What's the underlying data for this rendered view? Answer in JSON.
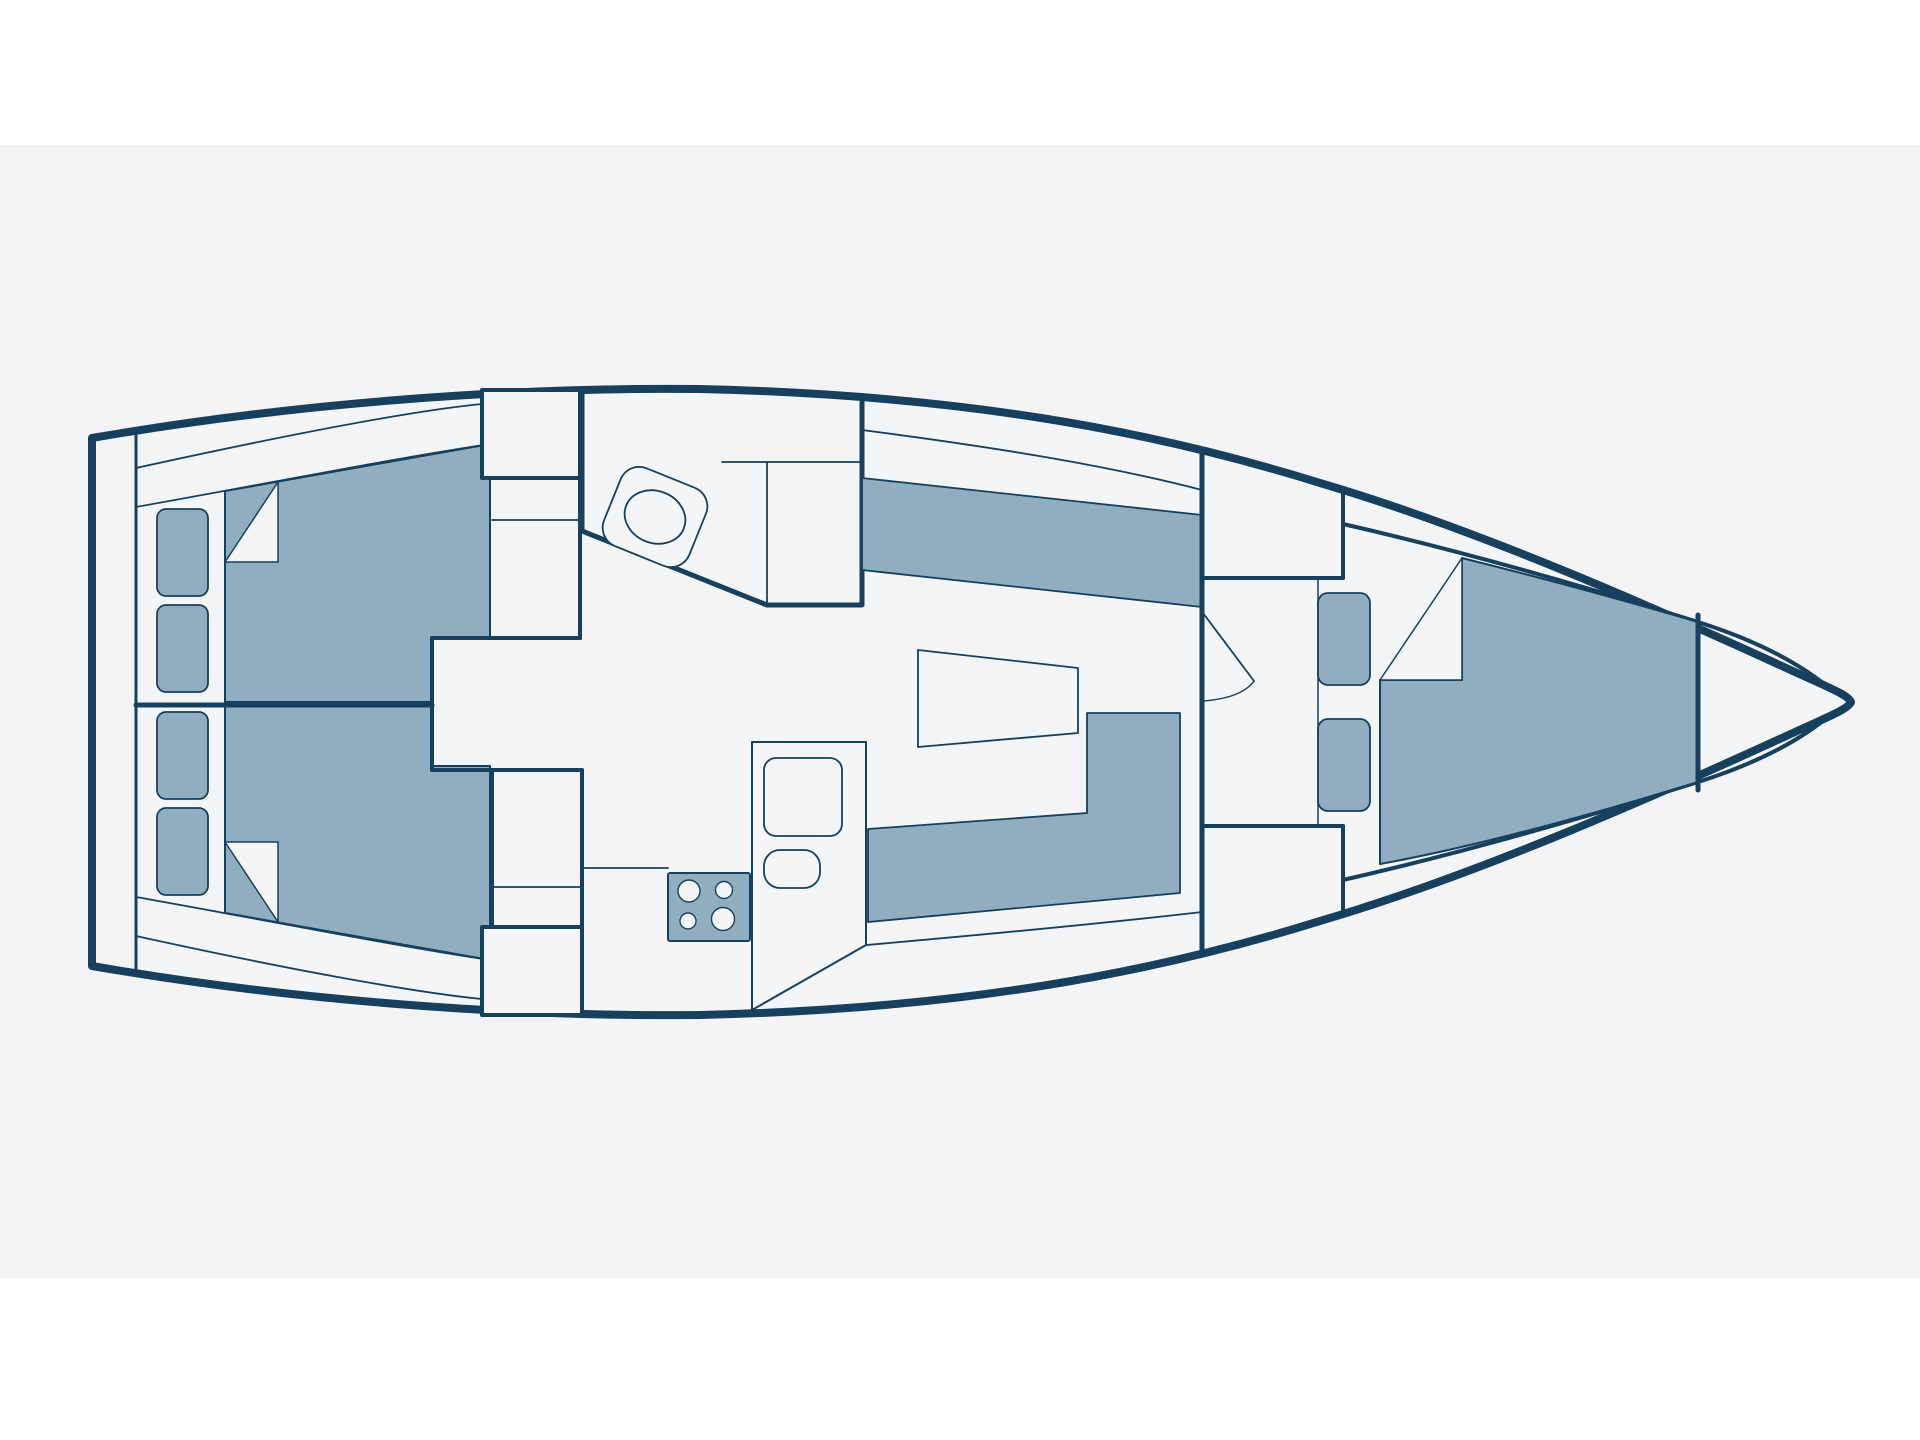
{
  "page": {
    "background": "#ffffff",
    "canvas_color": "#f4f4f6",
    "width": 1920,
    "height": 1440,
    "description": "Sailboat interior floor plan, top-down view, bow pointing right, no text labels"
  },
  "diagram": {
    "type": "boat-floor-plan",
    "colors": {
      "outline": "#16405e",
      "upholstery": "#91aec1",
      "surface": "#f4f4f6",
      "paper": "#f4f5f7"
    },
    "rooms": [
      {
        "name": "transom-lazarette"
      },
      {
        "name": "aft-cabin-port"
      },
      {
        "name": "aft-cabin-starboard"
      },
      {
        "name": "companionway-steps"
      },
      {
        "name": "head-toilet-room"
      },
      {
        "name": "galley"
      },
      {
        "name": "salon"
      },
      {
        "name": "forward-cabin"
      },
      {
        "name": "bow-anchor-locker"
      }
    ],
    "shapes": [
      {
        "name": "hull-outline",
        "kind": "path",
        "d": "M 92,438 C 300,402 520,387 700,389 C 960,395 1150,430 1320,483 C 1480,530 1660,610 1795,672 C 1830,688 1848,695 1851,702 C 1848,709 1830,716 1795,732 C 1660,794 1480,874 1320,921 C 1150,974 960,1009 700,1015 C 520,1017 300,1002 92,966 Z",
        "fill": "paper",
        "sw": 8
      },
      {
        "name": "transom-inner-wall",
        "kind": "path",
        "d": "M 136,431 L 136,973",
        "fill": "none",
        "sw": 3
      },
      {
        "name": "deck-line-top-outer",
        "kind": "path",
        "d": "M 136,468 C 300,432 420,410 482,404",
        "fill": "none",
        "sw": 1.8
      },
      {
        "name": "deck-line-top-inner",
        "kind": "path",
        "d": "M 136,507 C 260,485 390,459 490,444",
        "fill": "none",
        "sw": 1.8
      },
      {
        "name": "deck-line-top-salon",
        "kind": "path",
        "d": "M 862,430 C 1000,448 1110,466 1202,490",
        "fill": "none",
        "sw": 1.8
      },
      {
        "name": "deck-line-bottom-outer",
        "kind": "path",
        "d": "M 136,936 C 300,972 420,993 482,999",
        "fill": "none",
        "sw": 1.8
      },
      {
        "name": "deck-line-bottom-inner",
        "kind": "path",
        "d": "M 136,897 C 260,919 390,945 490,960",
        "fill": "none",
        "sw": 1.8
      },
      {
        "name": "deck-line-bottom-salon",
        "kind": "path",
        "d": "M 775,953 C 950,938 1090,925 1202,912",
        "fill": "none",
        "sw": 1.8
      },
      {
        "name": "fwd-trunk-line-top",
        "kind": "path",
        "d": "M 1343,524 C 1470,553 1590,588 1698,622 C 1755,640 1802,664 1834,692",
        "fill": "none",
        "sw": 4
      },
      {
        "name": "fwd-trunk-line-bottom",
        "kind": "path",
        "d": "M 1343,880 C 1470,851 1590,816 1698,782 C 1755,764 1802,740 1834,712",
        "fill": "none",
        "sw": 4
      },
      {
        "name": "aft-berth-port",
        "kind": "path",
        "d": "M 225,491 L 490,444 L 490,638 L 432,638 L 432,702 L 225,702 Z",
        "fill": "blue",
        "sw": 2
      },
      {
        "name": "aft-berth-starboard",
        "kind": "path",
        "d": "M 225,913 L 490,960 L 490,766 L 432,766 L 432,702 L 225,702 Z",
        "fill": "blue",
        "sw": 2
      },
      {
        "name": "pillow-port",
        "kind": "path",
        "d": "M 225,562 L 278,482 L 278,562 Z",
        "fill": "paper",
        "sw": 1.5
      },
      {
        "name": "pillow-starboard",
        "kind": "path",
        "d": "M 225,842 L 278,922 L 278,842 Z",
        "fill": "paper",
        "sw": 1.5
      },
      {
        "name": "shelf-cushion-port-1",
        "kind": "rect",
        "x": 157,
        "y": 509,
        "w": 51,
        "h": 87,
        "r": 9,
        "fill": "blue",
        "sw": 1.8
      },
      {
        "name": "shelf-cushion-port-2",
        "kind": "rect",
        "x": 157,
        "y": 605,
        "w": 51,
        "h": 87,
        "r": 9,
        "fill": "blue",
        "sw": 1.8
      },
      {
        "name": "shelf-cushion-stbd-1",
        "kind": "rect",
        "x": 157,
        "y": 712,
        "w": 51,
        "h": 87,
        "r": 9,
        "fill": "blue",
        "sw": 1.8
      },
      {
        "name": "shelf-cushion-stbd-2",
        "kind": "rect",
        "x": 157,
        "y": 808,
        "w": 51,
        "h": 87,
        "r": 9,
        "fill": "blue",
        "sw": 1.8
      },
      {
        "name": "cabin-divider-wall",
        "kind": "path",
        "d": "M 136,705 L 432,705",
        "fill": "none",
        "sw": 5
      },
      {
        "name": "companionway-top-box",
        "kind": "rect",
        "x": 482,
        "y": 390,
        "w": 98,
        "h": 88,
        "r": 0,
        "fill": "paper",
        "sw": 4
      },
      {
        "name": "companionway-shelf-line",
        "kind": "path",
        "d": "M 492,520 L 580,520",
        "fill": "none",
        "sw": 1.8
      },
      {
        "name": "companionway-side-wall",
        "kind": "path",
        "d": "M 580,478 L 580,638",
        "fill": "none",
        "sw": 4
      },
      {
        "name": "companionway-step-wall-top",
        "kind": "path",
        "d": "M 432,638 L 580,638",
        "fill": "none",
        "sw": 4
      },
      {
        "name": "companionway-step-wall-left",
        "kind": "path",
        "d": "M 432,638 L 432,770",
        "fill": "none",
        "sw": 4
      },
      {
        "name": "companionway-step-wall-bottom",
        "kind": "path",
        "d": "M 432,770 L 582,770",
        "fill": "none",
        "sw": 4
      },
      {
        "name": "galley-aft-counter",
        "kind": "rect",
        "x": 492,
        "y": 770,
        "w": 90,
        "h": 157,
        "r": 0,
        "fill": "paper",
        "sw": 4
      },
      {
        "name": "galley-aft-counter-divider",
        "kind": "path",
        "d": "M 492,887 L 582,887",
        "fill": "none",
        "sw": 1.8
      },
      {
        "name": "galley-aft-locker",
        "kind": "rect",
        "x": 482,
        "y": 927,
        "w": 100,
        "h": 88,
        "r": 0,
        "fill": "paper",
        "sw": 4
      },
      {
        "name": "head-walls",
        "kind": "path",
        "d": "M 582,392 L 582,531 L 767,605 L 862,605 L 862,402",
        "fill": "none",
        "sw": 5
      },
      {
        "name": "head-counter-line-h",
        "kind": "path",
        "d": "M 722,462 L 862,462",
        "fill": "none",
        "sw": 1.8
      },
      {
        "name": "head-counter-line-v",
        "kind": "path",
        "d": "M 767,462 L 767,605",
        "fill": "none",
        "sw": 1.8
      },
      {
        "name": "toilet-body",
        "kind": "rect",
        "x": 609,
        "y": 475,
        "w": 92,
        "h": 84,
        "r": 20,
        "fill": "paper",
        "sw": 1.8,
        "transform": "rotate(22 655 517)"
      },
      {
        "name": "toilet-bowl",
        "kind": "ellipse",
        "cx": 655,
        "cy": 517,
        "rx": 31,
        "ry": 26,
        "fill": "paper",
        "sw": 1.8,
        "transform": "rotate(22 655 517)"
      },
      {
        "name": "galley-entry-line",
        "kind": "path",
        "d": "M 582,868 L 668,868",
        "fill": "none",
        "sw": 1.8
      },
      {
        "name": "stove",
        "kind": "rect",
        "x": 668,
        "y": 873,
        "w": 82,
        "h": 68,
        "r": 2,
        "fill": "blue",
        "sw": 2
      },
      {
        "name": "stove-burner-1",
        "kind": "circle",
        "cx": 689,
        "cy": 891,
        "rr": 11,
        "fill": "paper",
        "sw": 1.4
      },
      {
        "name": "stove-burner-2",
        "kind": "circle",
        "cx": 724,
        "cy": 890,
        "rr": 8.5,
        "fill": "paper",
        "sw": 1.4
      },
      {
        "name": "stove-burner-3",
        "kind": "circle",
        "cx": 688,
        "cy": 921,
        "rr": 8,
        "fill": "paper",
        "sw": 1.4
      },
      {
        "name": "stove-burner-4",
        "kind": "circle",
        "cx": 723,
        "cy": 919,
        "rr": 11.5,
        "fill": "paper",
        "sw": 1.4
      },
      {
        "name": "galley-counter",
        "kind": "path",
        "d": "M 752,742 L 866,742 L 866,945 L 752,1010 Z",
        "fill": "paper",
        "sw": 2
      },
      {
        "name": "galley-fridge",
        "kind": "rect",
        "x": 764,
        "y": 758,
        "w": 78,
        "h": 78,
        "r": 12,
        "fill": "paper",
        "sw": 1.8
      },
      {
        "name": "galley-sink",
        "kind": "rect",
        "x": 764,
        "y": 850,
        "w": 56,
        "h": 38,
        "r": 16,
        "fill": "paper",
        "sw": 1.8
      },
      {
        "name": "salon-table",
        "kind": "path",
        "d": "M 918,650 L 1078,668 L 1078,733 L 918,747 Z",
        "fill": "paper",
        "sw": 1.8
      },
      {
        "name": "settee-port",
        "kind": "path",
        "d": "M 862,478 L 1202,515 L 1202,607 L 862,570 Z",
        "fill": "blue",
        "sw": 1.8
      },
      {
        "name": "settee-starboard",
        "kind": "path",
        "d": "M 868,829 L 1087,813 L 1087,713 L 1180,713 L 1180,893 L 868,922 Z",
        "fill": "blue",
        "sw": 1.8
      },
      {
        "name": "fwd-bulkhead",
        "kind": "path",
        "d": "M 1202,450 L 1202,950",
        "fill": "none",
        "sw": 5
      },
      {
        "name": "locker-top-bottom-edge",
        "kind": "path",
        "d": "M 1202,578 L 1343,578",
        "fill": "none",
        "sw": 4
      },
      {
        "name": "locker-top-right-edge",
        "kind": "path",
        "d": "M 1343,492 L 1343,578",
        "fill": "none",
        "sw": 4
      },
      {
        "name": "locker-bottom-top-edge",
        "kind": "path",
        "d": "M 1202,826 L 1343,826",
        "fill": "none",
        "sw": 4
      },
      {
        "name": "locker-bottom-right-edge",
        "kind": "path",
        "d": "M 1343,826 L 1343,910",
        "fill": "none",
        "sw": 4
      },
      {
        "name": "fwd-passage-line",
        "kind": "path",
        "d": "M 1318,578 L 1318,826",
        "fill": "none",
        "sw": 1.5
      },
      {
        "name": "cabin-door-leaf",
        "kind": "path",
        "d": "M 1203,613 L 1254,681",
        "fill": "none",
        "sw": 1.8
      },
      {
        "name": "cabin-door-swing-arc",
        "kind": "path",
        "d": "M 1254,681 Q 1242,698 1203,701",
        "fill": "none",
        "sw": 1.5
      },
      {
        "name": "fwd-seat-cushion-1",
        "kind": "rect",
        "x": 1318,
        "y": 593,
        "w": 52,
        "h": 92,
        "r": 10,
        "fill": "blue",
        "sw": 1.8
      },
      {
        "name": "fwd-seat-cushion-2",
        "kind": "rect",
        "x": 1318,
        "y": 719,
        "w": 52,
        "h": 92,
        "r": 10,
        "fill": "blue",
        "sw": 1.8
      },
      {
        "name": "v-berth",
        "kind": "path",
        "d": "M 1462,558 C 1550,580 1630,602 1698,622 L 1698,782 C 1600,812 1480,846 1380,864 L 1380,680 L 1462,680 Z",
        "fill": "blue",
        "sw": 2
      },
      {
        "name": "pillow-forward",
        "kind": "path",
        "d": "M 1380,680 L 1462,558 L 1462,680 Z",
        "fill": "paper",
        "sw": 1.5
      },
      {
        "name": "bow-bulkhead",
        "kind": "path",
        "d": "M 1698,615 L 1698,790",
        "fill": "none",
        "sw": 5
      }
    ]
  }
}
